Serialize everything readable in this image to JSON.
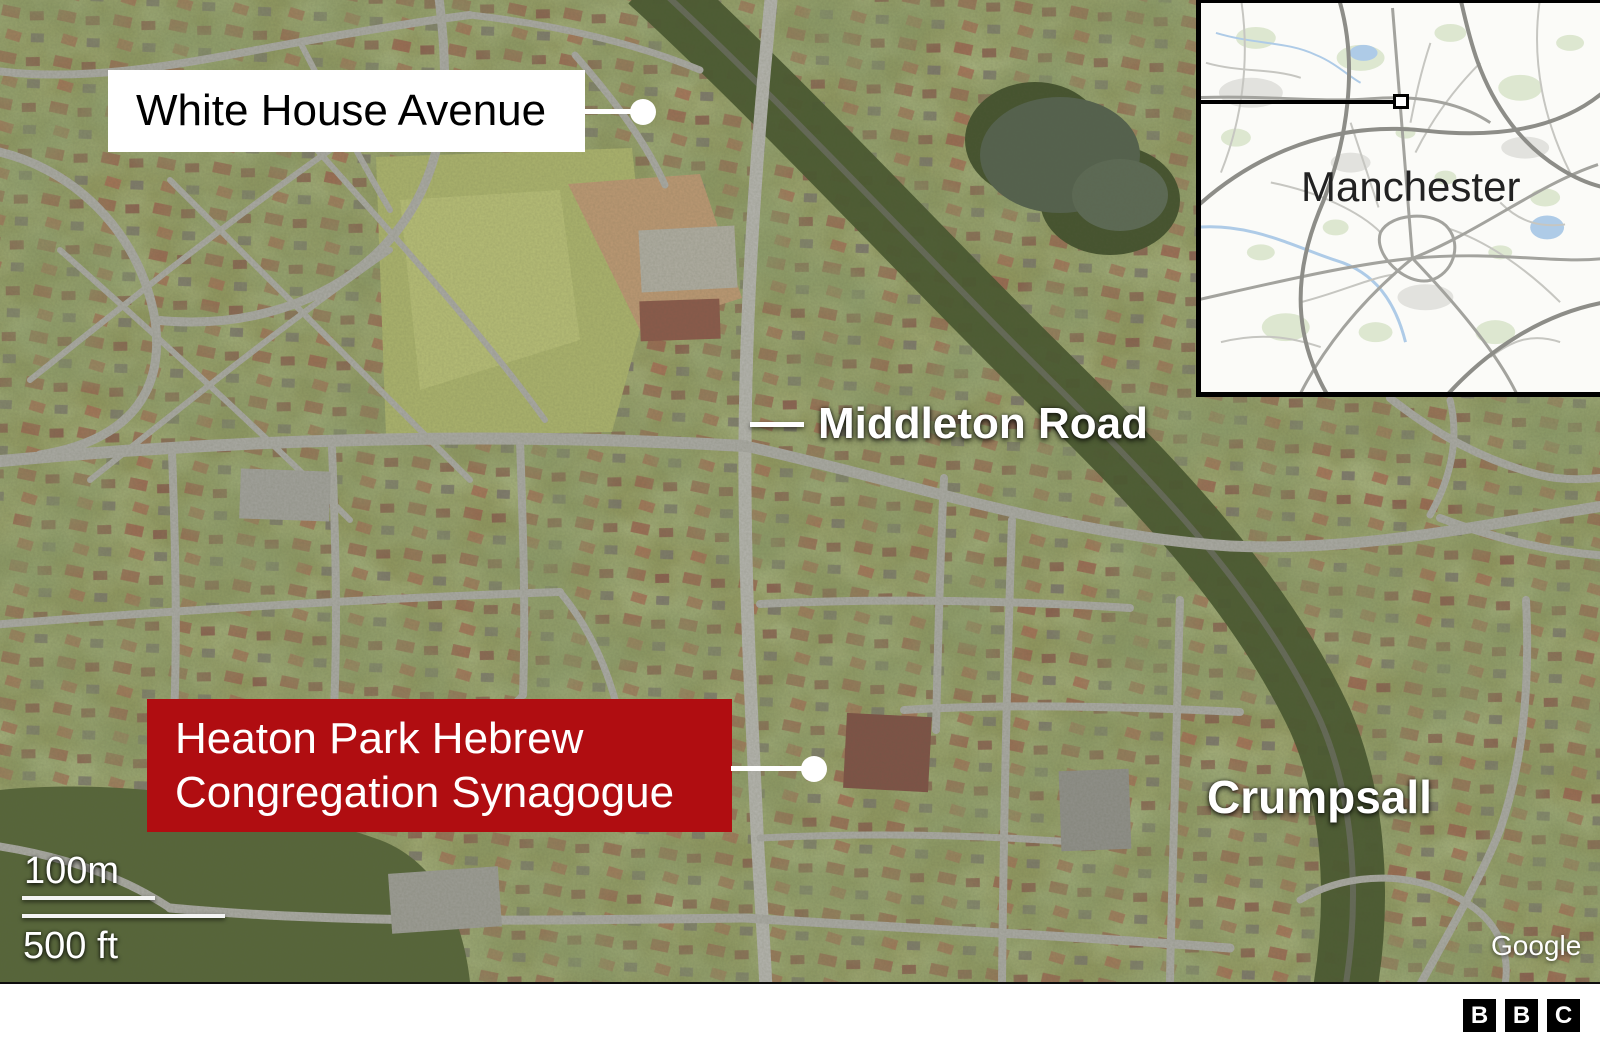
{
  "graphic": {
    "labels": {
      "street": "White House Avenue",
      "road": "Middleton Road",
      "poi_line1": "Heaton Park Hebrew",
      "poi_line2": "Congregation Synagogue",
      "district": "Crumpsall"
    },
    "scale": {
      "metric": "100m",
      "imperial": "500 ft"
    },
    "attribution": "Google",
    "inset": {
      "city": "Manchester"
    },
    "footer": {
      "bbc_letters": [
        "B",
        "B",
        "C"
      ]
    },
    "icons": {
      "location_dot": "white-circle-marker",
      "inset_marker": "square-extent-marker"
    },
    "colors": {
      "poi_box_red": "#b00d11",
      "label_box_white": "#ffffff",
      "label_text_black": "#000000",
      "map_label_white": "#ffffff",
      "inset_border_black": "#000000",
      "footer_bg": "#ffffff"
    }
  }
}
